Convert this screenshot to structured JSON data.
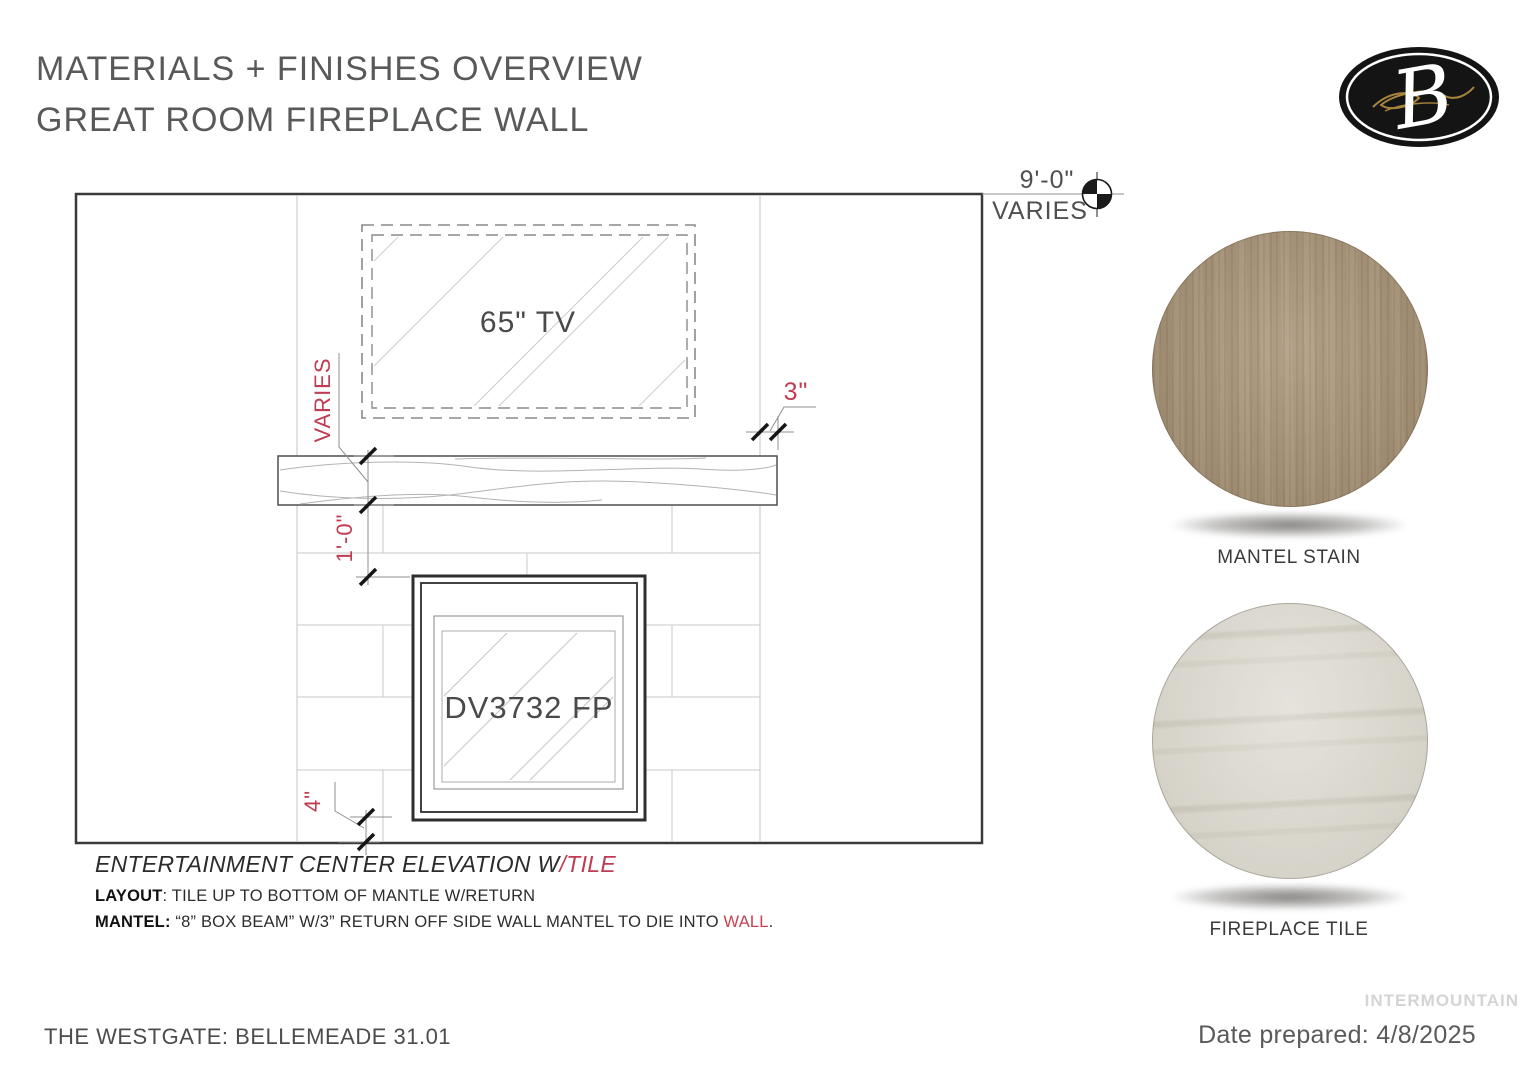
{
  "page": {
    "title_line1": "MATERIALS + FINISHES OVERVIEW",
    "title_line2": "GREAT ROOM FIREPLACE WALL"
  },
  "logo": {
    "letter": "B"
  },
  "drawing": {
    "tv_label": "65\" TV",
    "fireplace_label": "DV3732 FP",
    "dims": {
      "wall_width": "9'-0\"",
      "wall_width_note": "VARIES",
      "tv_gap": "VARIES",
      "mantel_to_fireplace": "1'-0\"",
      "mantel_side_return": "3\"",
      "fireplace_base": "4\""
    },
    "caption_main": "ENTERTAINMENT CENTER ELEVATION W",
    "caption_accent": "/TILE",
    "note_layout_label": "LAYOUT",
    "note_layout_text": ": TILE UP TO BOTTOM OF MANTLE W/RETURN",
    "note_mantel_label": "MANTEL:",
    "note_mantel_text": " “8” BOX BEAM” W/3” RETURN OFF SIDE WALL MANTEL TO DIE INTO ",
    "note_mantel_accent": "WALL",
    "note_mantel_end": "."
  },
  "swatches": [
    {
      "label": "MANTEL STAIN",
      "color": "#ab977c"
    },
    {
      "label": "FIREPLACE TILE",
      "color": "#dbd8ce"
    }
  ],
  "footer": {
    "project": "THE WESTGATE: BELLEMEADE 31.01",
    "watermark": "INTERMOUNTAIN",
    "date": "Date prepared: 4/8/2025"
  },
  "colors": {
    "annotation_red": "#bf3c52",
    "logo_gold": "#a8843c"
  }
}
